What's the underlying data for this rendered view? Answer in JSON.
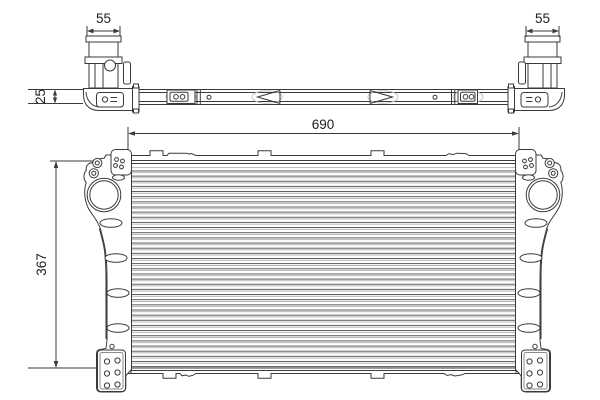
{
  "dimensions": {
    "port_left_width": "55",
    "port_right_width": "55",
    "assembly_depth": "25",
    "core_width": "690",
    "core_height": "367"
  },
  "style": {
    "line_color": "#3a3a3a",
    "light_line_color": "#c4c4c4",
    "fin_dark": "#4a4a4a",
    "fin_light": "#9b9b9b",
    "text_color": "#1e1e1e",
    "background": "#ffffff"
  }
}
